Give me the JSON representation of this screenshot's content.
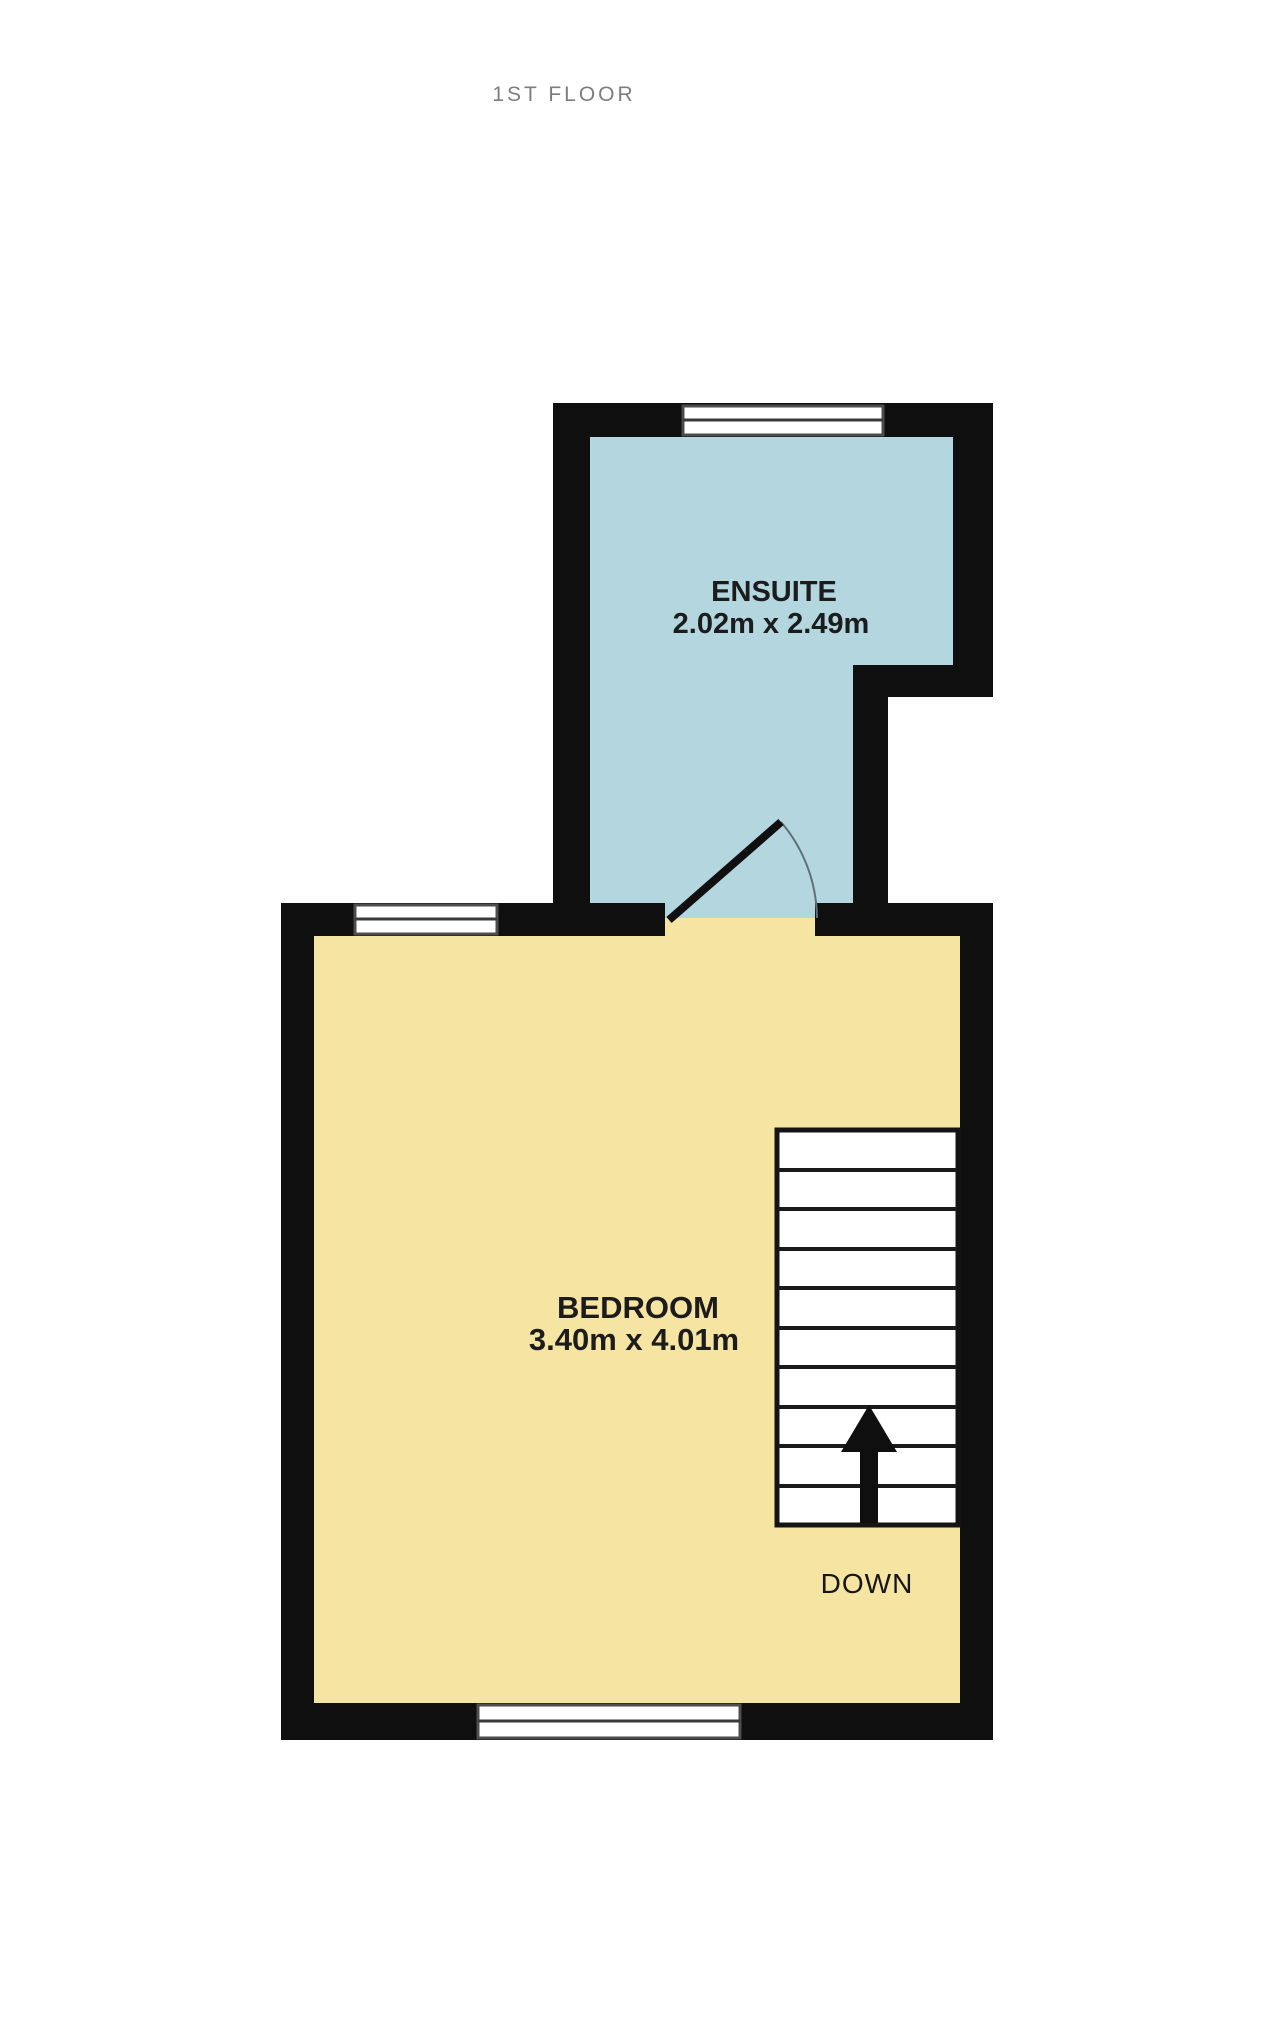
{
  "title": "1ST FLOOR",
  "rooms": {
    "ensuite": {
      "name": "ENSUITE",
      "dimensions": "2.02m x 2.49m"
    },
    "bedroom": {
      "name": "BEDROOM",
      "dimensions": "3.40m x 4.01m"
    }
  },
  "stairs": {
    "label": "DOWN",
    "treads": 10,
    "direction_icon": "up-arrow"
  },
  "colors": {
    "wall": "#0f0f0f",
    "ensuite_floor": "#b3d6df",
    "bedroom_floor": "#f6e4a3",
    "stairs_fill": "#ffffff",
    "window_fill": "#ffffff",
    "title_text": "#7d7d7d",
    "label_text": "#1c1c1c"
  }
}
